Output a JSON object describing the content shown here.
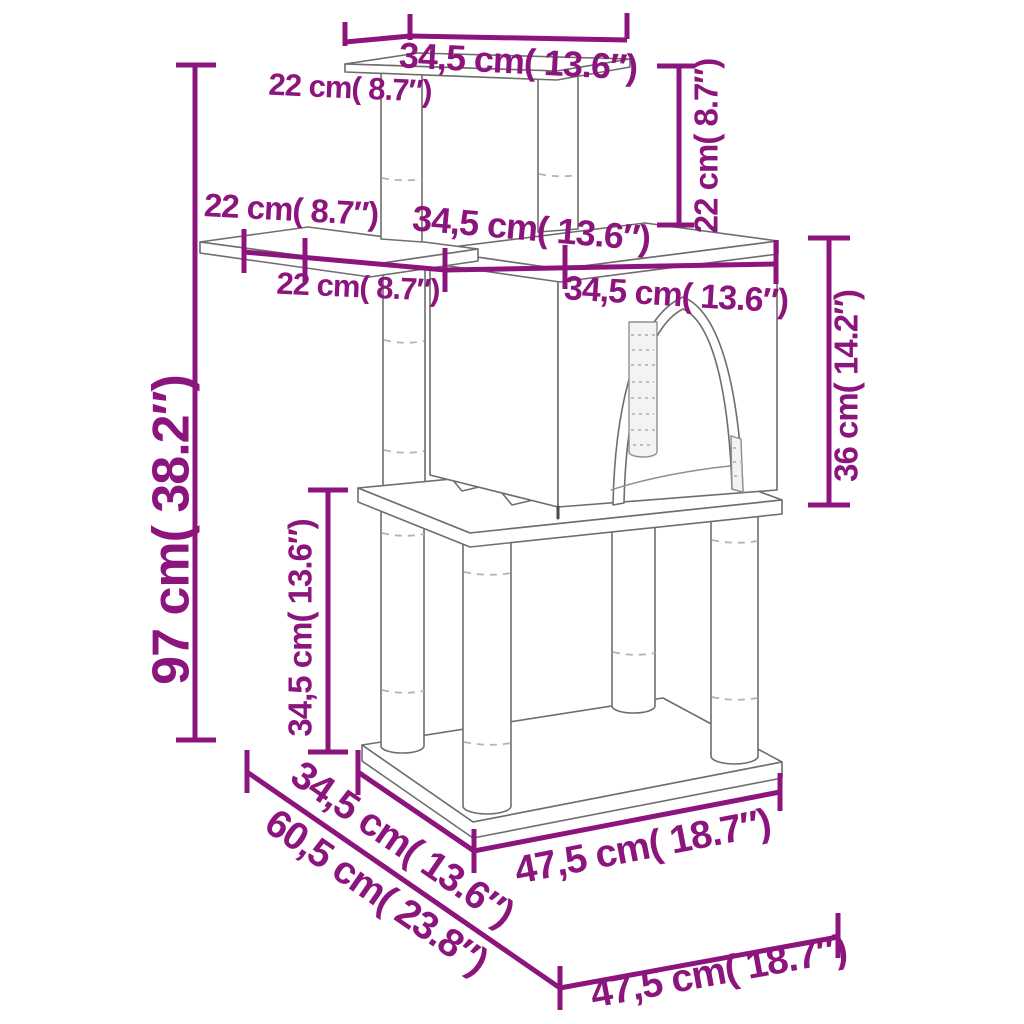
{
  "diagram": {
    "kind": "cat-tree-dimension-drawing",
    "colors": {
      "accent": "#8C147D",
      "outline": "#6e6e6e"
    },
    "labels": {
      "top_board_depth": "22 cm( 8.7″)",
      "top_board_width": "34,5 cm( 13.6″)",
      "top_post_height": "22 cm( 8.7″)",
      "shelf_depth": "22 cm( 8.7″)",
      "shelf_width": "22 cm( 8.7″)",
      "house_roof_depth": "34,5 cm( 13.6″)",
      "house_roof_width": "34,5 cm( 13.6″)",
      "total_height": "97 cm( 38.2″)",
      "middle_post_height": "34,5 cm( 13.6″)",
      "house_height": "36 cm( 14.2″)",
      "base_board_depth": "34,5 cm( 13.6″)",
      "base_board_width": "47,5 cm( 18.7″)",
      "footprint_depth": "60,5 cm( 23.8″)",
      "footprint_width": "47,5 cm( 18.7″)"
    }
  }
}
